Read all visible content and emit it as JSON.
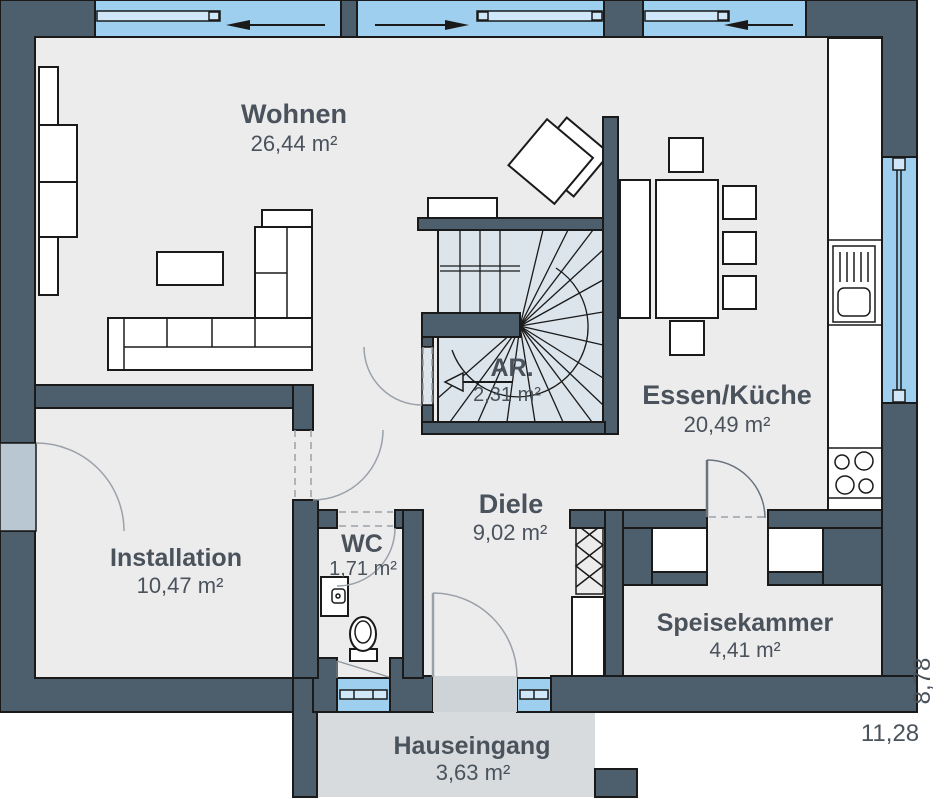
{
  "plan_title": "Ground floor plan",
  "rooms": {
    "wohnen": {
      "name": "Wohnen",
      "area": "26,44 m²"
    },
    "ar": {
      "name": "AR.",
      "area": "2,31 m²"
    },
    "essen": {
      "name": "Essen/Küche",
      "area": "20,49 m²"
    },
    "diele": {
      "name": "Diele",
      "area": "9,02 m²"
    },
    "installation": {
      "name": "Installation",
      "area": "10,47 m²"
    },
    "wc": {
      "name": "WC",
      "area": "1,71 m²"
    },
    "speisekammer": {
      "name": "Speisekammer",
      "area": "4,41 m²"
    },
    "hauseingang": {
      "name": "Hauseingang",
      "area": "3,63 m²"
    }
  },
  "dimensions": {
    "depth": "8,78",
    "width": "11,28"
  },
  "colors": {
    "wall": "#4d5e6c",
    "outline": "#1a1a1a",
    "floor": "#ececed",
    "stair_floor": "#dce5ec",
    "window": "#9fcfee",
    "window_panel": "#cfe7f8",
    "porch": "#d7dbde",
    "entrance_door": "#cdd3d7",
    "light_door": "#b9c7d2",
    "door_arc": "#9aa1a8",
    "text": "#4a525c"
  }
}
